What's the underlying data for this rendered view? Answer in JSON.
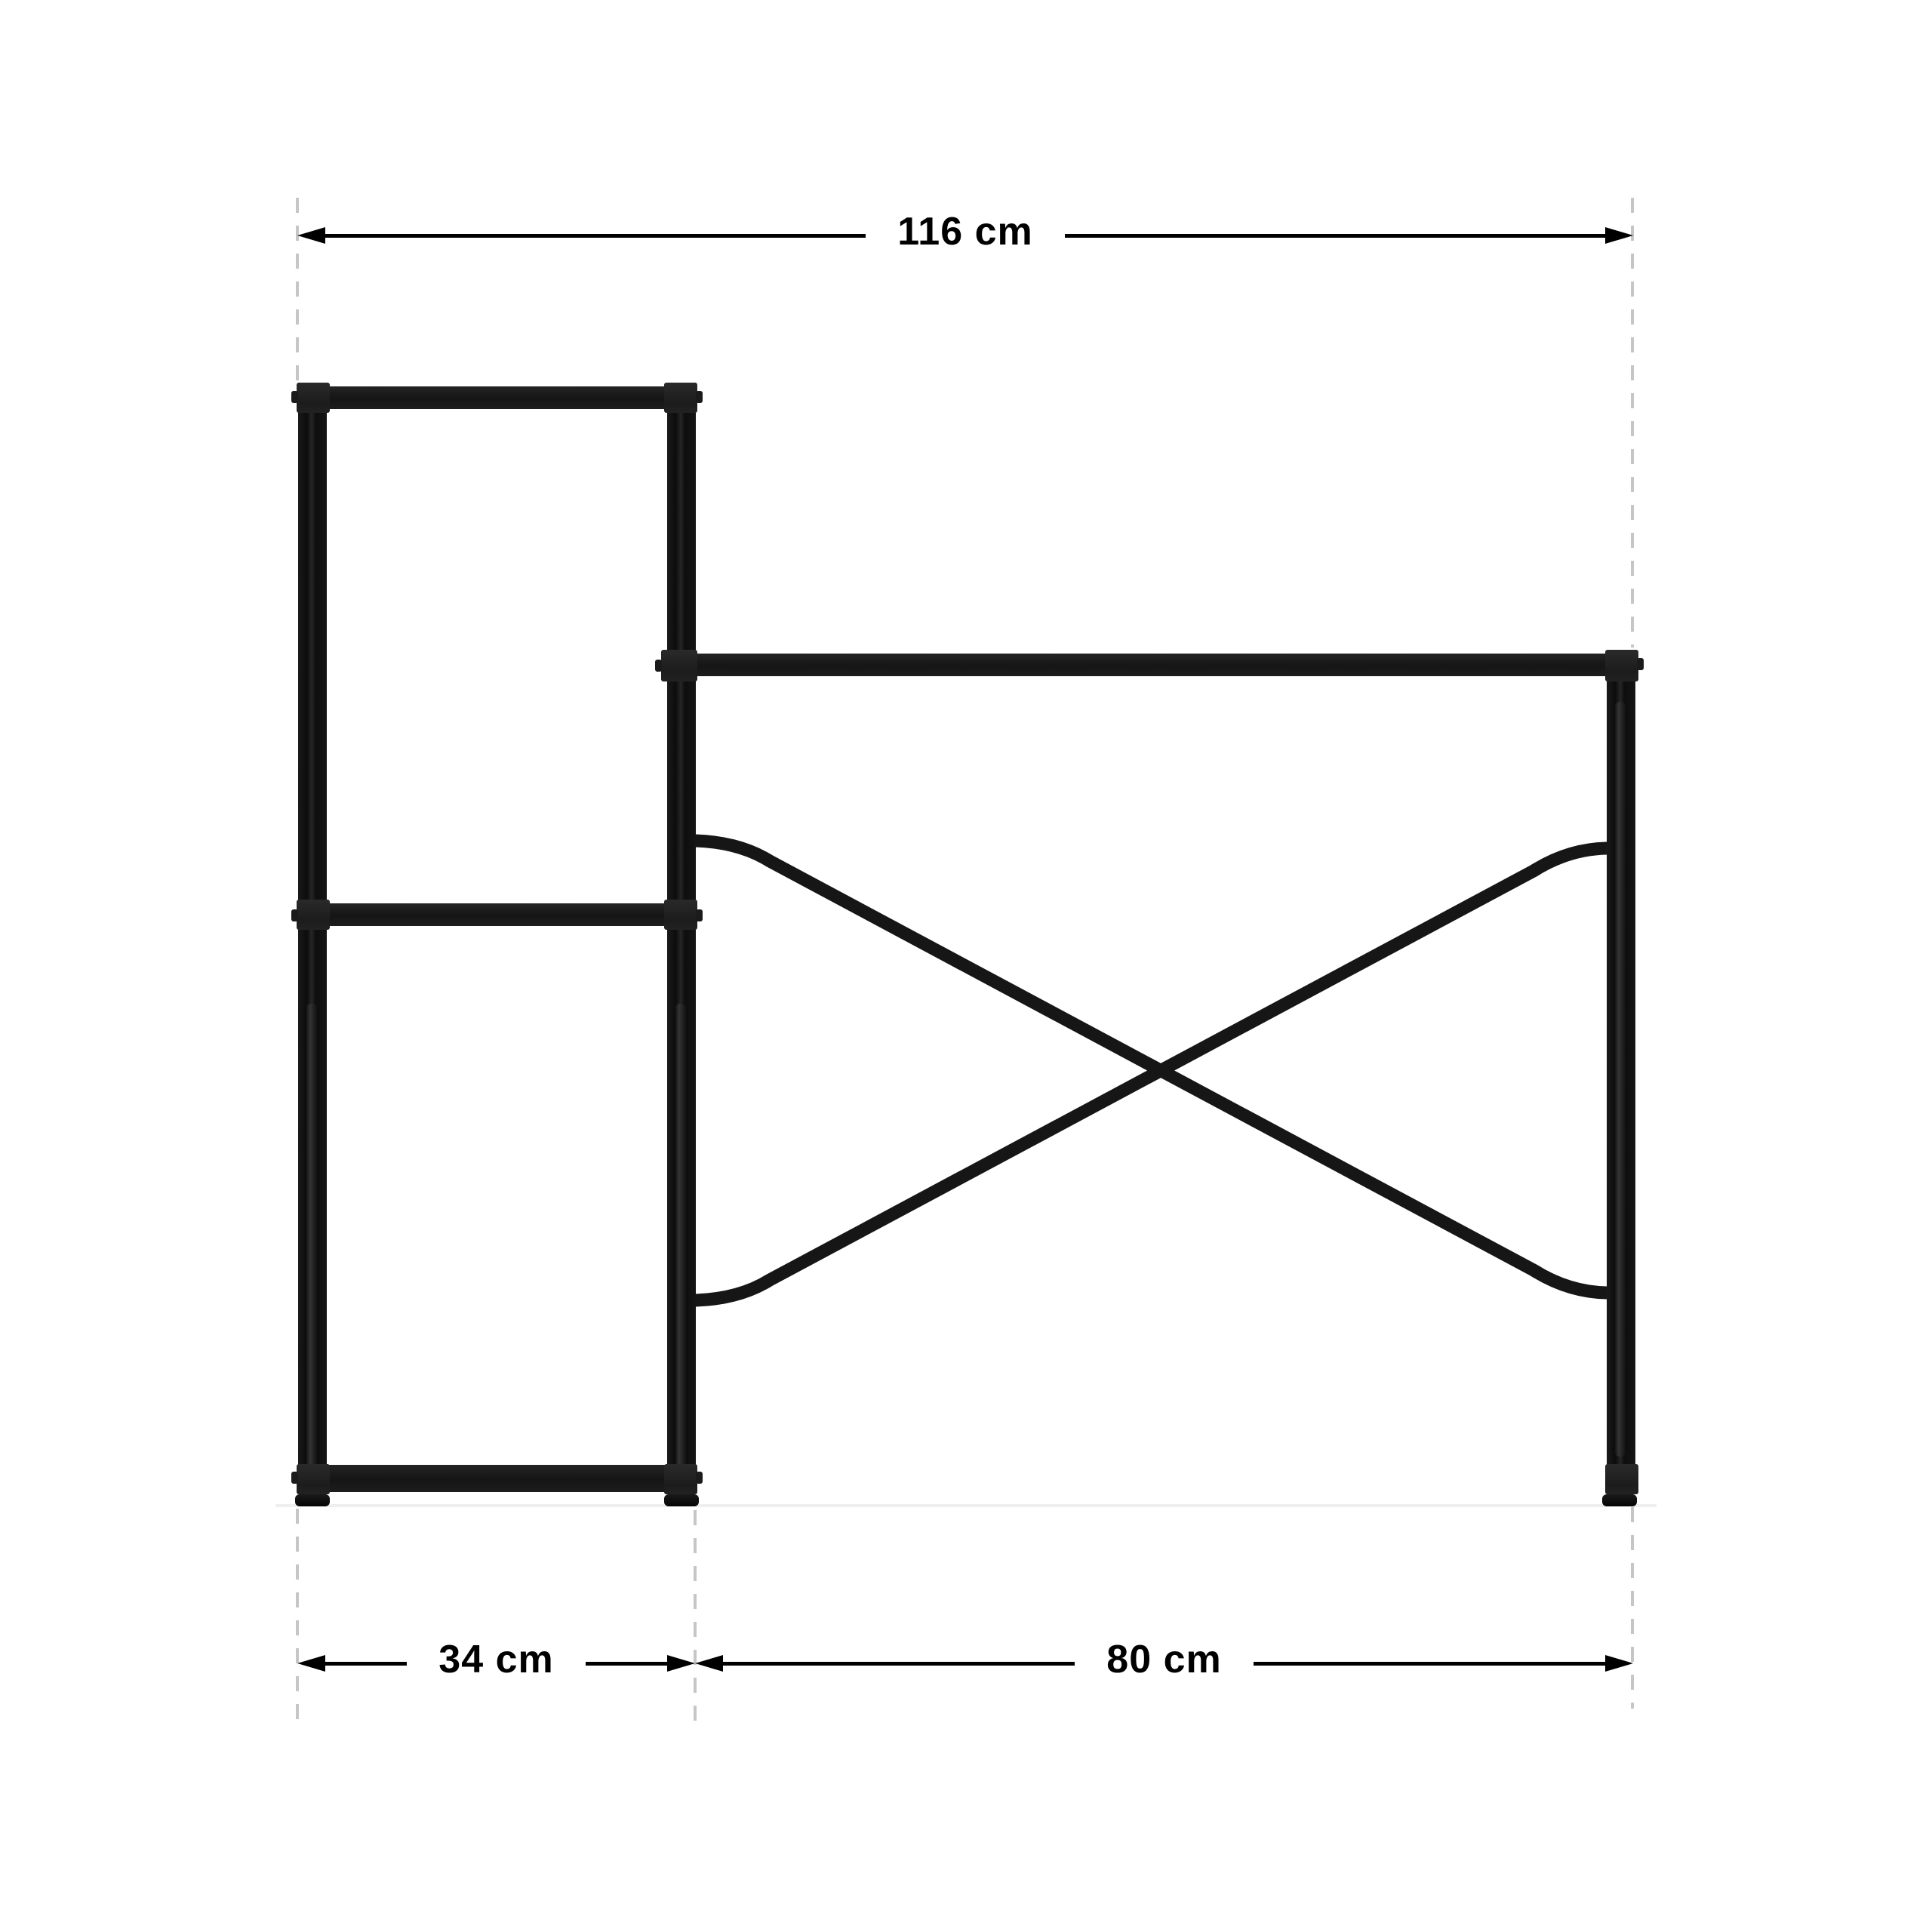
{
  "page": {
    "type": "product-dimension-diagram",
    "subject": "black metal desk frame with attached side shelf, front view",
    "background": "#ffffff"
  },
  "dimensions": {
    "overall_width": "116 cm",
    "shelf_width": "34 cm",
    "desk_width": "80 cm"
  },
  "values": {
    "overall_width_cm": 116,
    "shelf_width_cm": 34,
    "desk_width_cm": 80
  },
  "colors": {
    "frame": "#161616",
    "dimension_lines": "#000000",
    "dashed_guides": "#c6c6c6",
    "label_text": "#000000",
    "floor_shadow": "#efefef"
  }
}
